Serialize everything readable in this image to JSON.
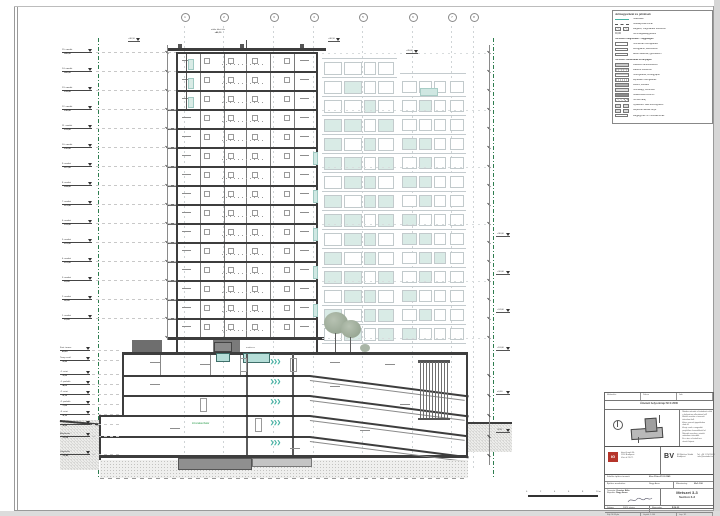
{
  "sheet": {
    "edge_color": "#cfcfcf"
  },
  "accent": {
    "teal": "#45b1a2",
    "green": "#2f9e4f",
    "slab": "#3d3d3d",
    "tint": "#d9ebe6",
    "red_logo": "#b5342a"
  },
  "grid": {
    "labels": [
      "1",
      "2",
      "3",
      "4",
      "5",
      "6",
      "7",
      "8"
    ]
  },
  "tower": {
    "floors": 15,
    "teal_floors": [
      5,
      7,
      9,
      11,
      13
    ]
  },
  "elevation": {
    "patterns": [
      "00000000",
      "01000000",
      "00100100",
      "11010000",
      "10101100",
      "11010100",
      "01101100",
      "10110100",
      "11011000",
      "01101100",
      "10100110",
      "11010100",
      "01101000",
      "10110100",
      "01011000"
    ]
  },
  "levels": {
    "tower": [
      {
        "name": "15. emelet",
        "elev": "+45,00"
      },
      {
        "name": "14. emelet",
        "elev": "+42,00"
      },
      {
        "name": "13. emelet",
        "elev": "+39,00"
      },
      {
        "name": "12. emelet",
        "elev": "+36,00"
      },
      {
        "name": "11. emelet",
        "elev": "+33,00"
      },
      {
        "name": "10. emelet",
        "elev": "+30,00"
      },
      {
        "name": "9. emelet",
        "elev": "+27,00"
      },
      {
        "name": "8. emelet",
        "elev": "+24,00"
      },
      {
        "name": "7. emelet",
        "elev": "+21,00"
      },
      {
        "name": "6. emelet",
        "elev": "+18,00"
      },
      {
        "name": "5. emelet",
        "elev": "+15,00"
      },
      {
        "name": "4. emelet",
        "elev": "+12,00"
      },
      {
        "name": "3. emelet",
        "elev": "+9,00"
      },
      {
        "name": "2. emelet",
        "elev": "+6,00"
      },
      {
        "name": "1. emelet",
        "elev": "+3,00"
      }
    ],
    "podium": [
      {
        "name": "Fszt. terasz",
        "elev": "±0,00"
      },
      {
        "name": "Terep csatl.",
        "elev": "-0,90"
      },
      {
        "name": "-1. szint",
        "elev": "-3,20"
      },
      {
        "name": "-1. parkoló",
        "elev": "-4,05"
      },
      {
        "name": "-2. szint",
        "elev": "-6,15"
      },
      {
        "name": "-2. parkoló",
        "elev": "-7,00"
      },
      {
        "name": "-3. szint",
        "elev": "-9,10"
      },
      {
        "name": "-3. parkoló",
        "elev": "-9,95"
      },
      {
        "name": "Alaplemez",
        "elev": "-11,60"
      },
      {
        "name": "Szigetelés",
        "elev": "-12,40"
      }
    ],
    "right": [
      "+36,00",
      "+30,00",
      "+24,00",
      "+18,00",
      "±0,00",
      "-3,20"
    ]
  },
  "annotations": {
    "roof_note_1": "attika felső éle",
    "roof_note_2": "+46,10",
    "roof_markers": [
      "+46,10",
      "+46,10",
      "+45,60"
    ],
    "green_label": "tűzszakaszhatár",
    "pool_label": "medence"
  },
  "legend": {
    "title": "Jelmagyarázat és jelölések",
    "rows": [
      {
        "sw": "teal",
        "label": "Telekhatár"
      },
      {
        "sw": "dash",
        "label": "Szabályozási vonal"
      },
      {
        "sw": "hatchpair",
        "label": "Meglévő, megmaradó szerkezet"
      },
      {
        "sw": "pm",
        "label": "Szintmagasság-jelölés"
      },
      {
        "sw": "header",
        "label": "Tervezett rétegrendek – függőleges"
      },
      {
        "sw": "outline",
        "label": "Homlokzati hőszigetelés"
      },
      {
        "sw": "outline",
        "label": "Kéregpanel, látszóbeton"
      },
      {
        "sw": "outline",
        "label": "Belső válaszfal, gipszkarton"
      },
      {
        "sw": "header",
        "label": "Tervezett szerkezetek és anyagok"
      },
      {
        "sw": "box",
        "bg": "#c9c9c9",
        "label": "Vasbeton tartószerkezet"
      },
      {
        "sw": "grid",
        "label": "Falazott szerkezet"
      },
      {
        "sw": "hlines",
        "label": "Hőszigetelés, kőzetgyapot"
      },
      {
        "sw": "vlines",
        "label": "Lépésálló hőszigetelés"
      },
      {
        "sw": "box",
        "bg": "#aeaeae",
        "label": "Kavics, feltöltés"
      },
      {
        "sw": "dots",
        "label": "Homokágy, tömörített"
      },
      {
        "sw": "box",
        "bg": "#8b8b8b",
        "label": "Szálerősített esztrich"
      },
      {
        "sw": "diagsw",
        "label": "Termett talaj"
      },
      {
        "sw": "pair",
        "label": "Nyílászáró: lásd konszignáció"
      },
      {
        "sw": "pair",
        "label": "Gépészeti aknák helye"
      },
      {
        "sw": "boxw",
        "label": "Megjegyzés: ld. műszaki leírás"
      }
    ]
  },
  "titleblock": {
    "rev_cells": [
      "Módosítás",
      "Dátum",
      "Jele"
    ],
    "header": "Átnézeti helyszínrajz  M=1:2000",
    "notes": [
      "Minden méretet a kivitelezés előtt",
      "a helyszínen ellenőrizni kell!",
      "Eltérés esetén a tervezőt",
      "értesíteni kell.",
      "A terv szerzői jogvédelem",
      "alatt áll.",
      "A rajz csak a megadott",
      "projekthez használható fel.",
      "Méretek mm-ben, szintek",
      "méterben értendők.",
      "Ez a terv a kiviteli terv",
      "részét képezi."
    ],
    "logo_left_mark": "IG",
    "logo_left_lines": [
      "Inter-Graph Kft.",
      "1134 Budapest",
      "Váci út 23-27."
    ],
    "logo_right_mark": "BV",
    "logo_right_lines": [
      "BV Építész Stúdió",
      "Budapest"
    ],
    "logo_right_side": [
      "Tel: +36 1 234 5678",
      "info@bvstudio.hu"
    ],
    "f1_label": "Felelős építész tervező:",
    "f1_value": "Kiss Péter  É 01-2345",
    "f2_label": "Építész munkatárs:",
    "f2_value": "Nagy Anna",
    "scale_label": "Méretarány:",
    "scale_value": "M=1:100",
    "drawn_label": "Rajzolta:",
    "drawn_value": "Nagy Anna",
    "designed_label": "Tervezte:",
    "designed_value": "Kovács Béla",
    "date_label": "Dátum:",
    "date_value": "2023. június",
    "num_label": "Rajzszám:",
    "num_value": "É-M-33",
    "title_main": "Metszet 3-3",
    "title_sub": "Section 3-3",
    "bottom_cells": [
      "Fájl: M-33.pln",
      "Lépték: 1:100",
      "Lap: 1/1"
    ]
  },
  "scalebar": {
    "labels": [
      "0",
      "2",
      "4",
      "6",
      "8",
      "10 m"
    ]
  }
}
